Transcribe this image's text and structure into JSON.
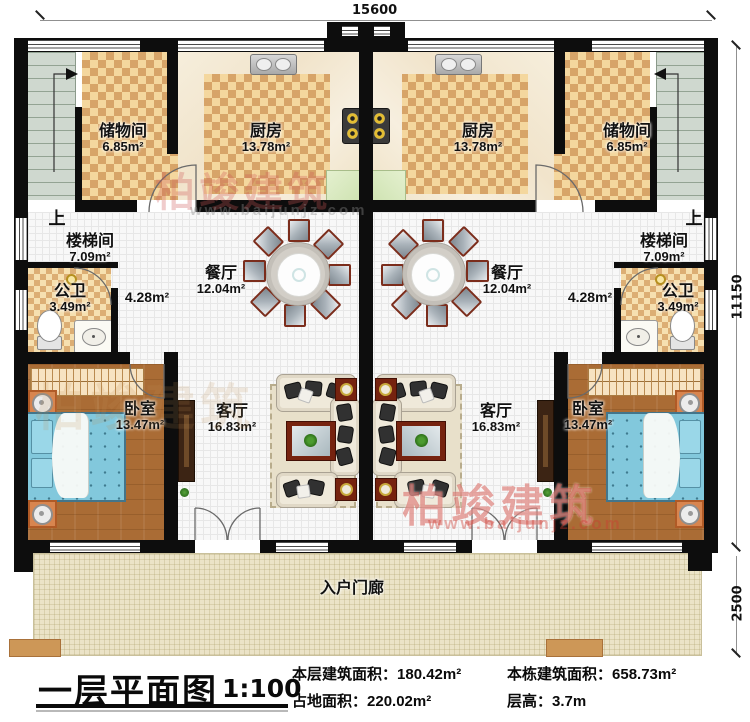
{
  "drawing": {
    "type": "floor-plan",
    "mirrored_units": true
  },
  "title_block": {
    "title": "一层平面图",
    "scale": "1:100",
    "stats": [
      {
        "label": "本层建筑面积：",
        "value": "180.42m²"
      },
      {
        "label": "占地面积：",
        "value": "220.02m²"
      },
      {
        "label": "本栋建筑面积：",
        "value": "658.73m²"
      },
      {
        "label": "层高：",
        "value": "3.7m"
      }
    ]
  },
  "dimensions": {
    "top": "15600",
    "right_upper": "11150",
    "right_lower": "2500"
  },
  "rooms": {
    "storage": {
      "name": "储物间",
      "area": "6.85m²"
    },
    "kitchen": {
      "name": "厨房",
      "area": "13.78m²"
    },
    "stairwell": {
      "name": "楼梯间",
      "area": "7.09m²"
    },
    "bathroom": {
      "name": "公卫",
      "area": "3.49m²"
    },
    "hallway": {
      "area": "4.28m²"
    },
    "dining": {
      "name": "餐厅",
      "area": "12.04m²"
    },
    "bedroom": {
      "name": "卧室",
      "area": "13.47m²"
    },
    "living": {
      "name": "客厅",
      "area": "16.83m²"
    },
    "porch": {
      "name": "入户门廊"
    }
  },
  "annotations": {
    "up": "上"
  },
  "watermark": {
    "brand": "柏竣建筑",
    "url": "www.baijunjz.com"
  },
  "colors": {
    "wall": "#0d0d0d",
    "tile_dark": "#d7a468",
    "tile_light": "#f4d79e",
    "wood": "#aa6c35",
    "bed": "#82c8dc",
    "stairs": "#cfd8cf",
    "porch": "#ebe3c7",
    "watermark_red": "#cc4a42"
  }
}
